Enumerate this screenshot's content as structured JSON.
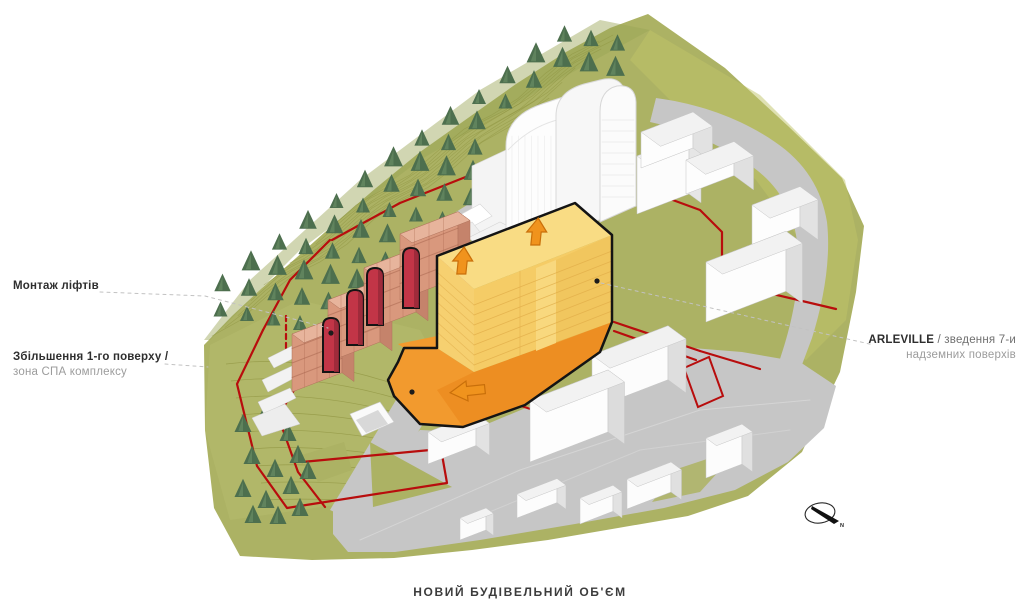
{
  "diagram": {
    "title": "НОВИЙ БУДІВЕЛЬНИЙ ОБ'ЄМ",
    "labels": {
      "elevators": "Монтаж ліфтів",
      "ground_floor_line1": "Збільшення 1-го поверху /",
      "ground_floor_line2": "зона СПА комплексу",
      "arleville_name": "ARLEVILLE",
      "arleville_rest": " / зведення 7-и",
      "arleville_line2": "надземних поверхів"
    },
    "compass": {
      "north": "N"
    },
    "colors": {
      "new_volume_yellow": "#F5CC66",
      "new_volume_roof": "#F9DC84",
      "plinth_orange": "#F29A2E",
      "arrow_orange": "#F0931D",
      "boundary_red": "#B80D0D",
      "elevator_red": "#C23547",
      "existing_salmon": "#D9987D",
      "hill_green": "#ACB264",
      "road_gray": "#C6C6C6"
    }
  }
}
